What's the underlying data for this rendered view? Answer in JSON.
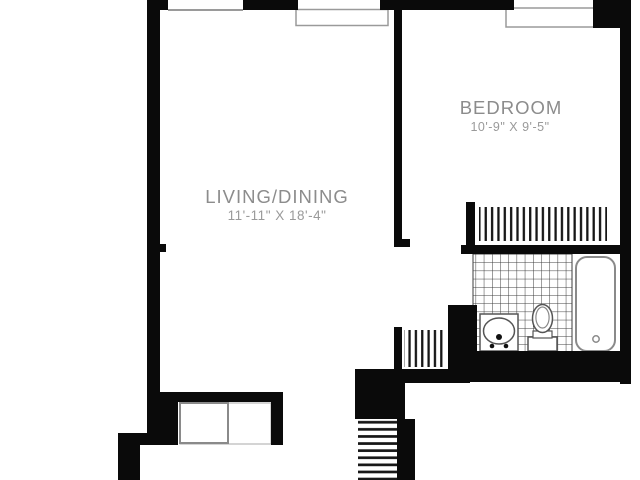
{
  "plan": {
    "type": "apartment-floor-plan",
    "rooms": {
      "living_dining": {
        "label": "LIVING/DINING",
        "dimensions": "11'-11\" X 18'-4\""
      },
      "bedroom": {
        "label": "BEDROOM",
        "dimensions": "10'-9\" X 9'-5\""
      }
    },
    "colors": {
      "wall": "#0a0a0a",
      "label_text": "#8c8c8c",
      "dimension_text": "#9a9a9a",
      "fixture_line": "#555555",
      "tile_line": "#3c3c3c",
      "background": "#ffffff"
    }
  }
}
